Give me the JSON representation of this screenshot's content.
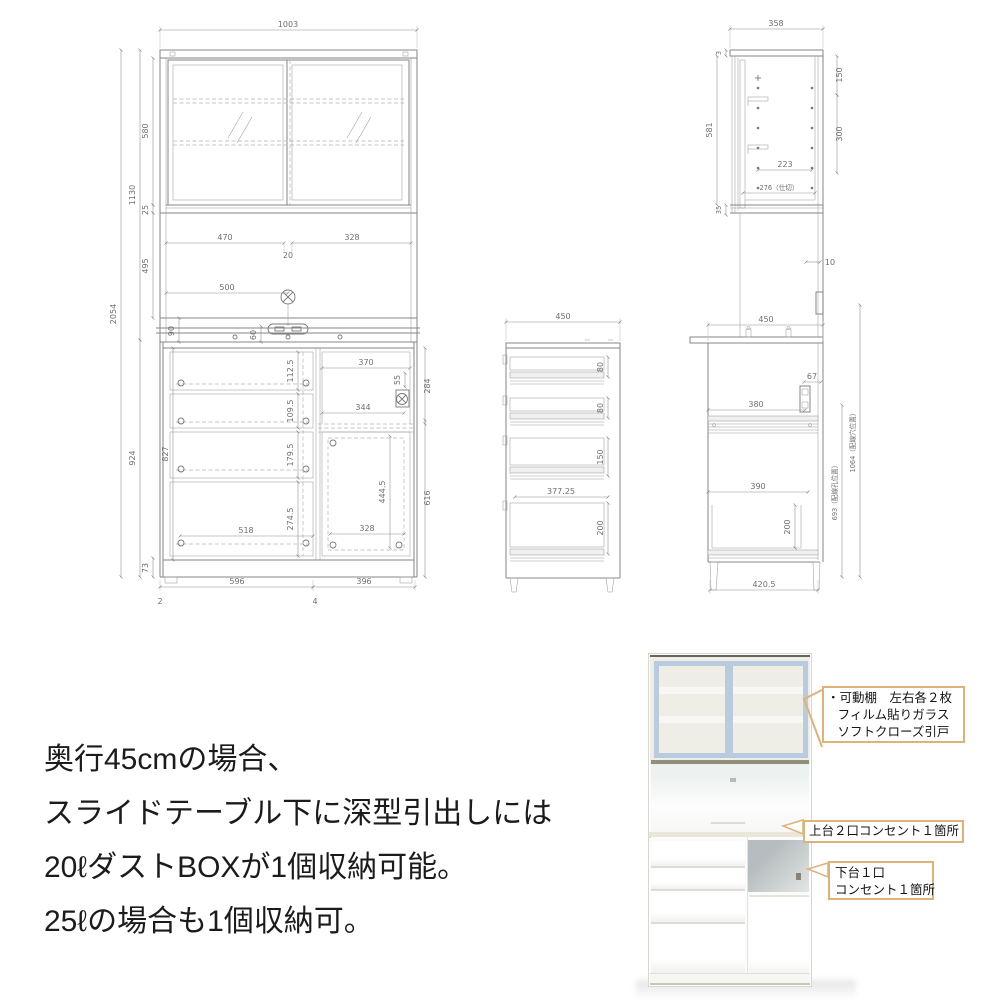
{
  "figure": {
    "front_view": {
      "overall_width": "1003",
      "overall_height": "2054",
      "upper_section_height": "1130",
      "lower_section_height": "924",
      "glass_door_height": "580",
      "track_rail_height": "25",
      "open_space_height": "495",
      "left_door_width": "470",
      "door_overlap": "20",
      "right_door_width": "328",
      "light_position": "500",
      "counter_back_height": "90",
      "outlet_offset": "60",
      "drawer1_height": "112.5",
      "drawer2_height": "109.5",
      "drawer3_height": "179.5",
      "drawer4_height": "274.5",
      "drawer_inner_width": "518",
      "lower_inner_height": "827",
      "base_height": "73",
      "bottom_left_width": "596",
      "bottom_right_width": "396",
      "label_left": "2",
      "label_right": "4",
      "niche_width": "370",
      "niche_outlet_offset": "55",
      "niche_height": "284",
      "niche_shelf_width": "344",
      "door_inner_height": "444.5",
      "right_door_height": "616"
    },
    "side_view_upper": {
      "depth": "358",
      "top_clearance": "3",
      "inner_height": "581",
      "bottom_clearance": "35",
      "top_pitch": "150",
      "shelf_pitch": "300",
      "shelf_depth": "223",
      "partition_depth": "276（仕切）",
      "back_clearance": "10"
    },
    "side_view_lower": {
      "depth": "450",
      "outlet_offset": "67",
      "slide_table_depth": "380",
      "drawer_inner_depth": "390",
      "drawer_depth": "200",
      "base_depth": "420.5",
      "lower_hole_height": "693（配線孔位置）",
      "upper_hole_height": "1064（配線穴位置）"
    },
    "drawer_section_view": {
      "depth": "450",
      "drawer1_depth": "80",
      "drawer2_depth": "80",
      "drawer3_depth": "150",
      "drawer4_depth": "200",
      "inner_depth": "377.25"
    }
  },
  "description": {
    "line1": "奥行45cmの場合、",
    "line2": "スライドテーブル下に深型引出しには",
    "line3": "20ℓダストBOXが1個収納可能。",
    "line4": "25ℓの場合も1個収納可。"
  },
  "photo_callouts": {
    "movable_shelf_line1": "・可動棚　左右各２枚",
    "movable_shelf_line2": "フィルム貼りガラス",
    "movable_shelf_line3": "ソフトクローズ引戸",
    "upper_outlet": "上台２口コンセント１箇所",
    "lower_outlet_line1": "下台１口",
    "lower_outlet_line2": "コンセント１箇所"
  },
  "colors": {
    "callout_border": "#e0b27a",
    "drawing_line": "#868686",
    "dimension_text": "#6f6f6f",
    "glass": "#a7c2d2",
    "glass_frame": "#b9cbde",
    "niche": "#c0c5c6"
  }
}
